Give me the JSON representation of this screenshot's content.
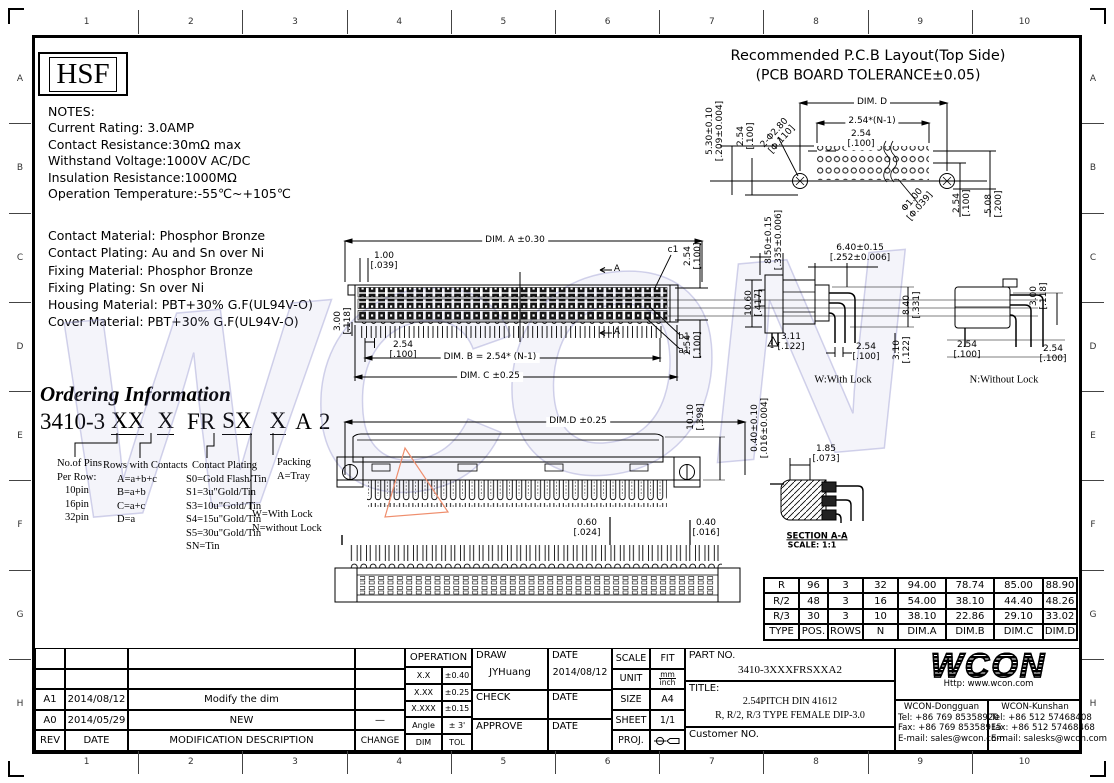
{
  "frame": {
    "cols": [
      "1",
      "2",
      "3",
      "4",
      "5",
      "6",
      "7",
      "8",
      "9",
      "10"
    ],
    "rows": [
      "A",
      "B",
      "C",
      "D",
      "E",
      "F",
      "G",
      "H"
    ]
  },
  "brand": {
    "logo": "HSF"
  },
  "notes": {
    "title": "NOTES:",
    "lines": [
      "Current  Rating:  3.0AMP",
      "Contact  Resistance:30mΩ max",
      "Withstand  Voltage:1000V  AC/DC",
      "Insulation  Resistance:1000MΩ",
      "Operation  Temperature:-55℃~+105℃"
    ]
  },
  "materials": {
    "lines": [
      "Contact  Material:  Phosphor  Bronze",
      "Contact  Plating:  Au  and  Sn  over  Ni",
      "Fixing  Material:  Phosphor  Bronze",
      "Fixing  Plating:  Sn  over  Ni",
      "Housing  Material:  PBT+30%  G.F(UL94V-O)",
      "Cover  Material:  PBT+30%  G.F(UL94V-O)"
    ]
  },
  "ordering": {
    "title": "Ordering Information",
    "code_prefix": "3410-3",
    "code_fields": [
      "XX",
      "X",
      "FR",
      "SX",
      "X",
      "A",
      "2"
    ],
    "pins_title": "No.of Pins",
    "pins_sub": "Per Row:",
    "pins": [
      "10pin",
      "16pin",
      "32pin"
    ],
    "rows_title": "Rows with Contacts",
    "rows": [
      "A=a+b+c",
      "B=a+b",
      "C=a+c",
      "D=a"
    ],
    "plating_title": "Contact Plating",
    "plating": [
      "S0=Gold Flash/Tin",
      "S1=3u\"Gold/Tin",
      "S3=10u\"Gold/Tin",
      "S4=15u\"Gold/Tin",
      "S5=30u\"Gold/Tin",
      "SN=Tin"
    ],
    "lock": [
      "W=With Lock",
      "N=without Lock"
    ],
    "packing_title": "Packing",
    "packing": [
      "A=Tray"
    ]
  },
  "pcb": {
    "title": "Recommended  P.C.B  Layout(Top  Side)",
    "subtitle": "(PCB  BOARD  TOLERANCE±0.05)",
    "dim_height": "5.30±0.10\n[.209±0.004]",
    "dim_pitch_v": "2.54\n[.100]",
    "dim_hole_big": "2-Φ2.80\n[Φ.110]",
    "dim_d": "DIM. D",
    "dim_span": "2.54*(N-1)",
    "dim_pitch": "2.54\n[.100]",
    "dim_hole_small": "Φ1.00\n[Φ.039]",
    "dim_row_pitch": "2.54\n[.100]",
    "dim_row_span": "5.08\n[.200]"
  },
  "front": {
    "dim_a": "DIM. A ±0.30",
    "dim_100": "1.00\n[.039]",
    "dim_300": "3.00\n[.118]",
    "dim_254": "2.54\n[.100]",
    "dim_b": "DIM. B = 2.54* (N-1)",
    "dim_c": "DIM. C ±0.25",
    "row_c1": "c1",
    "row_b1": "b1",
    "row_a1": "a1",
    "dim_254_top": "2.54\n[.100]",
    "dim_254_bot": "2.54\n[.100]",
    "section_a": "A"
  },
  "lock": {
    "dim_850": "8.50±0.15\n[.335±0.006]",
    "dim_640": "6.40±0.15\n[.252±0.006]",
    "dim_1060": "10.60\n[.417]",
    "dim_840": "8.40\n[.331]",
    "dim_311": "3.11\n[.122]",
    "dim_254": "2.54\n[.100]",
    "dim_310": "3.10\n[.122]",
    "rev_flag": "1",
    "caption": "W:With Lock"
  },
  "nolock": {
    "dim_300": "3.00\n[.118]",
    "dim_254_l": "2.54\n[.100]",
    "dim_254_r": "2.54\n[.100]",
    "caption": "N:Without Lock"
  },
  "dimd": {
    "dim_d": "DIM.D  ±0.25",
    "dim_1010": "10.10\n[.398]"
  },
  "section": {
    "dim_040": "0.40±0.10\n[.016±0.004]",
    "dim_185": "1.85\n[.073]",
    "caption": "SECTION A-A",
    "scale": "SCALE: 1:1"
  },
  "rear": {
    "dim_060": "0.60\n[.024]",
    "dim_040": "0.40\n[.016]"
  },
  "spec_table": {
    "rows": [
      [
        "R",
        "96",
        "3",
        "32",
        "94.00",
        "78.74",
        "85.00",
        "88.90"
      ],
      [
        "R/2",
        "48",
        "3",
        "16",
        "54.00",
        "38.10",
        "44.40",
        "48.26"
      ],
      [
        "R/3",
        "30",
        "3",
        "10",
        "38.10",
        "22.86",
        "29.10",
        "33.02"
      ],
      [
        "TYPE",
        "POS.",
        "ROWS",
        "N",
        "DIM.A",
        "DIM.B",
        "DIM.C",
        "DIM.D"
      ]
    ]
  },
  "titleblock": {
    "revisions": {
      "rows": [
        [
          "A1",
          "2014/08/12",
          "Modify  the  dim",
          ""
        ],
        [
          "A0",
          "2014/05/29",
          "NEW",
          "—"
        ]
      ],
      "headers": [
        "REV",
        "DATE",
        "MODIFICATION  DESCRIPTION",
        "CHANGE"
      ]
    },
    "operation": {
      "title": "OPERATION",
      "rows": [
        [
          "X.X",
          "±0.40"
        ],
        [
          "X.XX",
          "±0.25"
        ],
        [
          "X.XXX",
          "±0.15"
        ],
        [
          "Angle",
          "± 3'"
        ],
        [
          "DIM",
          "TOL"
        ]
      ]
    },
    "sign": {
      "draw_label": "DRAW",
      "draw_name": "JYHuang",
      "draw_date_label": "DATE",
      "draw_date": "2014/08/12",
      "check_label": "CHECK",
      "check_date_label": "DATE",
      "approve_label": "APPROVE",
      "approve_date_label": "DATE"
    },
    "meta": {
      "scale_label": "SCALE",
      "scale": "FIT",
      "unit_label": "UNIT",
      "unit_top": "mm",
      "unit_bottom": "inch",
      "size_label": "SIZE",
      "size": "A4",
      "sheet_label": "SHEET",
      "sheet": "1/1",
      "proj_label": "PROJ."
    },
    "part": {
      "label": "PART  NO.",
      "value": "3410-3XXXFRSXXA2"
    },
    "title": {
      "label": "TITLE:",
      "line1": "2.54PITCH DIN 41612",
      "line2": "R, R/2, R/3 TYPE FEMALE DIP-3.0"
    },
    "customer_label": "Customer  NO.",
    "wcon": {
      "logo": "WCON",
      "url": "Http:  www.wcon.com",
      "dongguan": {
        "name": "WCON-Dongguan",
        "tel": "Tel:  +86 769 85358920",
        "fax": "Fax:  +86 769 85358915",
        "email": "E-mail:  sales@wcon.com"
      },
      "kunshan": {
        "name": "WCON-Kunshan",
        "tel": "Tel:  +86 512 57468408",
        "fax": "Fax:  +86 512 57468468",
        "email": "E-mail:  salesks@wcon.com"
      }
    }
  },
  "watermark": "WCON"
}
